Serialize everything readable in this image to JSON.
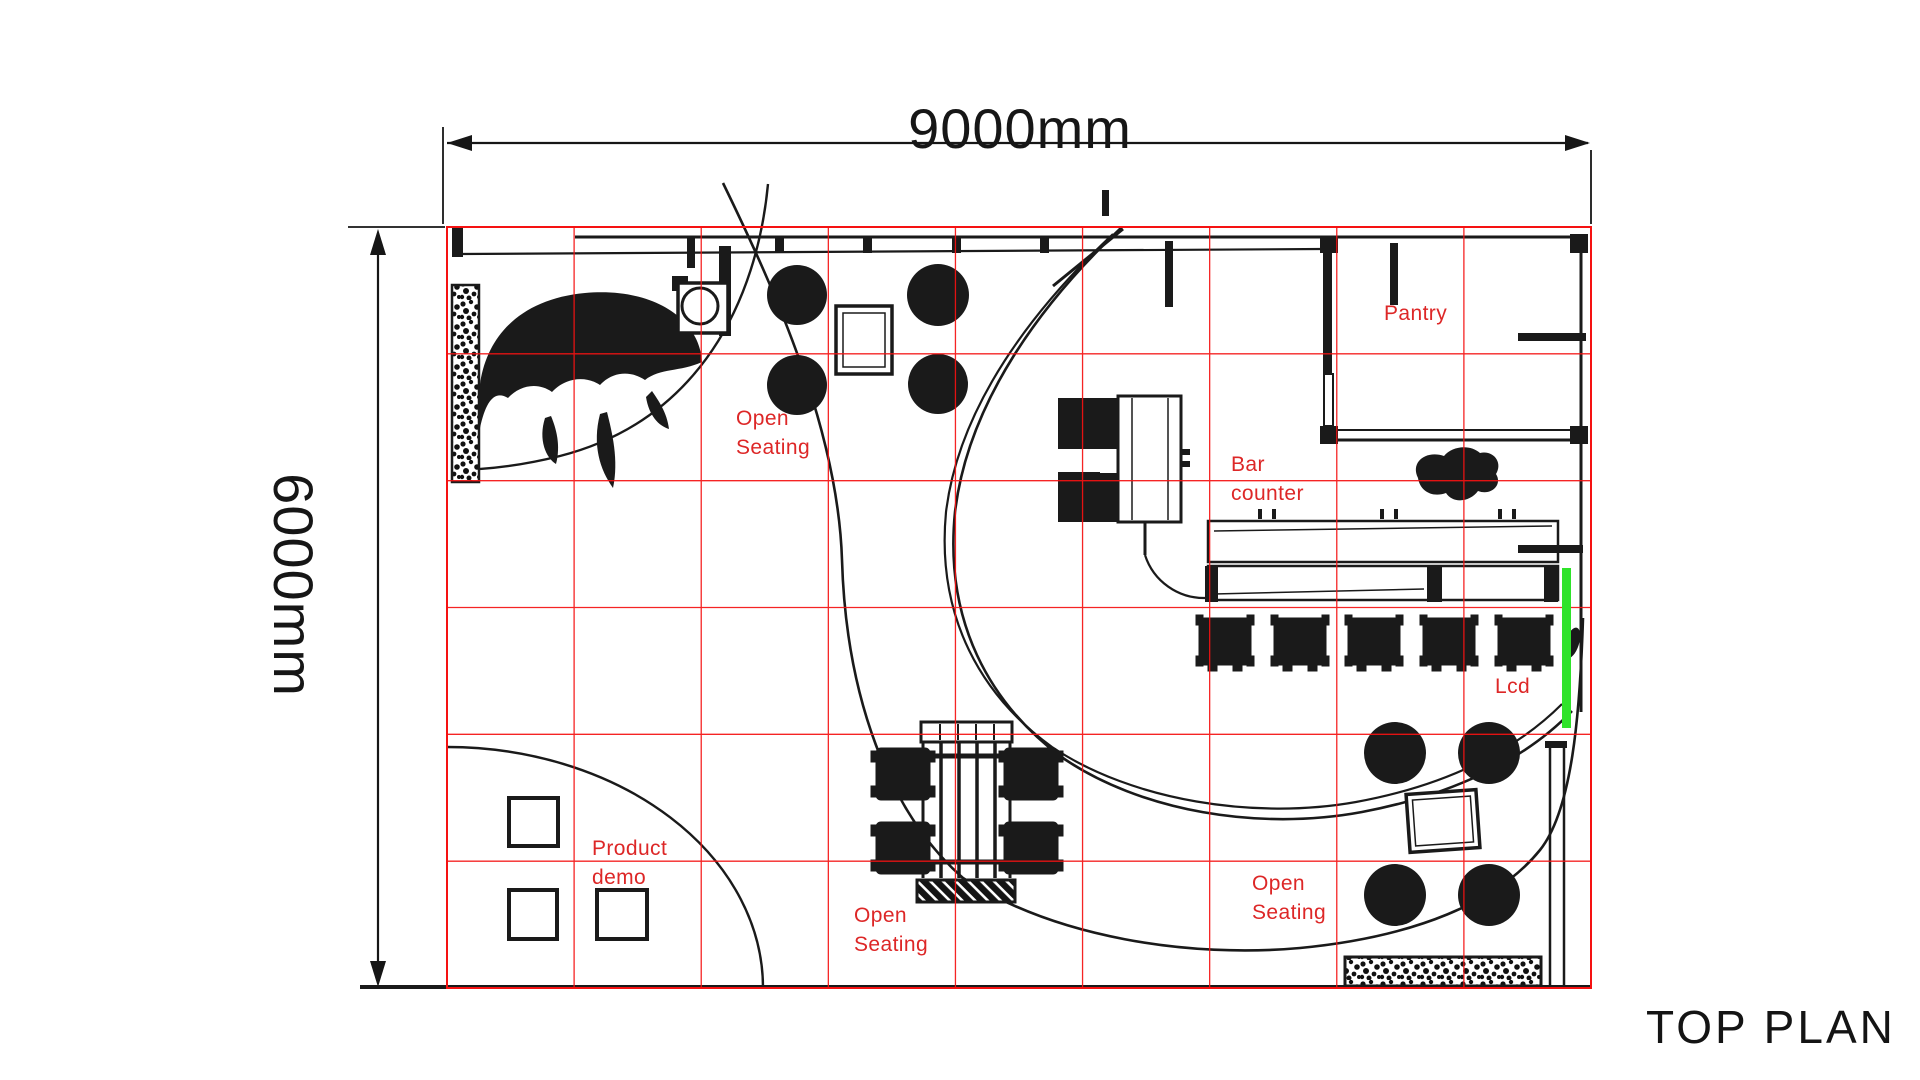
{
  "page": {
    "title": "TOP PLAN"
  },
  "dimensions": {
    "horizontal": "9000mm",
    "vertical": "6000mm",
    "plan_width_mm": 9000,
    "plan_height_mm": 6000
  },
  "grid": {
    "columns": 9,
    "rows": 6,
    "cell_mm": 1000,
    "color": "#f51212"
  },
  "colors": {
    "linework": "#1a1a1a",
    "label_red": "#dd2727",
    "lcd_green": "#2fe32a",
    "background": "#ffffff"
  },
  "labels": {
    "open_seating_top": "Open\nSeating",
    "bar_counter": "Bar\ncounter",
    "pantry": "Pantry",
    "lcd": "Lcd",
    "product_demo": "Product\ndemo",
    "open_seating_bottom": "Open\nSeating",
    "open_seating_right": "Open\nSeating"
  }
}
